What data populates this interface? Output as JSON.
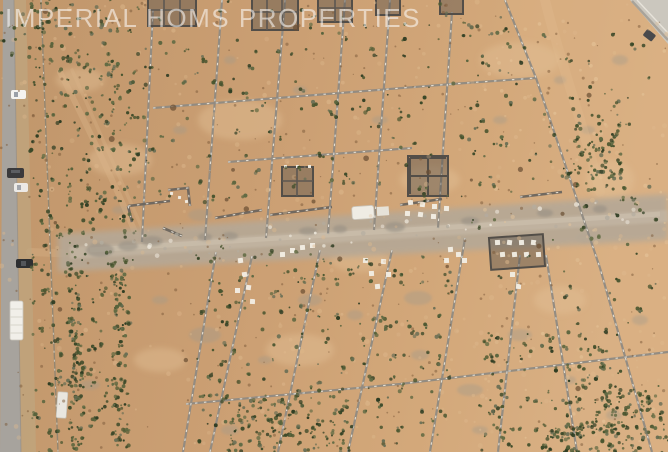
{
  "meta": {
    "type": "aerial-drone-photograph",
    "subject": "Top-down aerial view of a desert land subdivision: sandy plots divided by concrete block walls under construction, a paved road along the left edge, building foundations, white footing pads, a dusty access track across the middle, scattered desert shrubs"
  },
  "watermark": {
    "text": "IMPERIAL HOMS PROPERTIES",
    "color": "rgba(255,255,255,0.55)"
  },
  "palette": {
    "sand": "#c89c70",
    "sand_light": "#d8af83",
    "sand_dark": "#b98e63",
    "road": "#a7a39d",
    "pavement": "#cbc7be",
    "track": "#b5a896",
    "wall": "#8f8a82",
    "wall_pillar": "#ece7dc",
    "structure": "#57524d",
    "shrub": "#49552f",
    "pad": "#f2eee5",
    "rubble": "#9e968a",
    "watermark": "rgba(255,255,255,0.55)"
  },
  "scene": {
    "road": {
      "position": "left edge",
      "orientation": "vertical"
    },
    "track": {
      "position": "across middle",
      "orientation": "horizontal, rising to the right"
    },
    "vehicles": [
      {
        "name": "white-car-north",
        "color": "white",
        "location": "left road"
      },
      {
        "name": "dark-suv",
        "color": "dark gray",
        "location": "left road"
      },
      {
        "name": "white-car-south",
        "color": "white",
        "location": "left road"
      },
      {
        "name": "black-car",
        "color": "black",
        "location": "left road shoulder"
      },
      {
        "name": "white-bus",
        "color": "white",
        "location": "left road"
      },
      {
        "name": "white-trailer",
        "color": "white",
        "location": "field, lower left"
      },
      {
        "name": "white-van",
        "color": "white",
        "location": "middle track"
      },
      {
        "name": "dark-car-corner",
        "color": "dark gray",
        "location": "top right pavement"
      }
    ],
    "features": [
      "plot-boundary-walls",
      "pillared-perimeter-wall",
      "building-foundation-grids",
      "white-footing-pads",
      "rubble-piles",
      "desert-shrubs",
      "paved-corner-top-right"
    ]
  }
}
